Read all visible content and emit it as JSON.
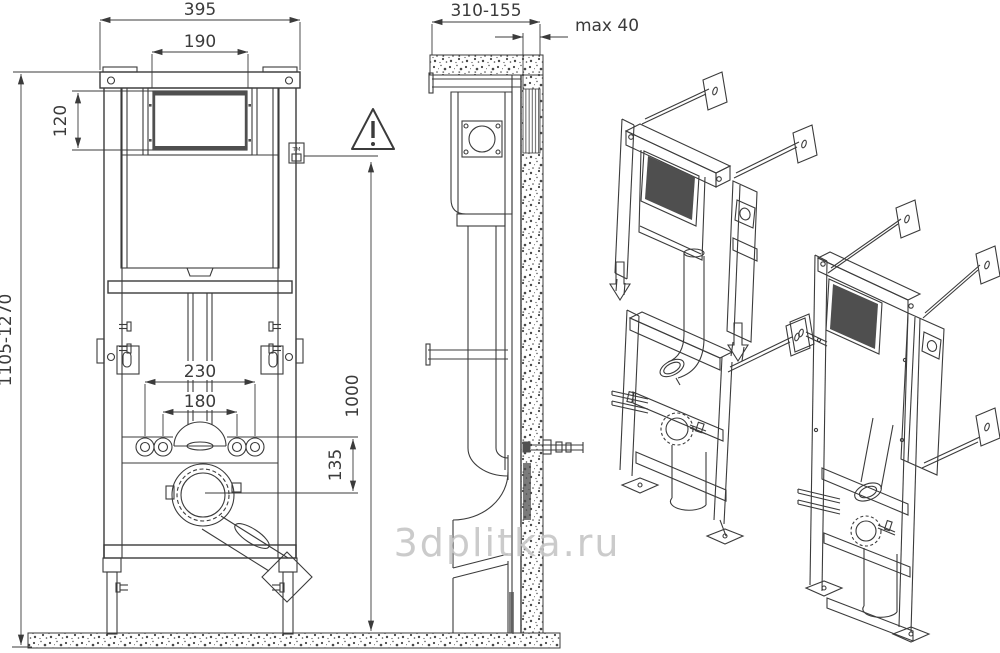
{
  "colors": {
    "line": "#3b3b3b",
    "dark": "#4f4f4f",
    "watermark": "#c6c6c6",
    "speckle": "#474747"
  },
  "watermark": {
    "text": "3dplitka.ru"
  },
  "front_view": {
    "dims": {
      "overall_width": "395",
      "opening_width": "190",
      "opening_height": "120",
      "frame_height_range": "1105-1270",
      "fixing_bolt_spacing_outer": "230",
      "fixing_bolt_spacing_inner": "180",
      "outlet_drop": "135",
      "actuation_height": "1000"
    },
    "trademark_label": "TM"
  },
  "side_view": {
    "dims": {
      "mounting_depth_range": "310-155",
      "max_wall_finish": "max 40"
    }
  }
}
